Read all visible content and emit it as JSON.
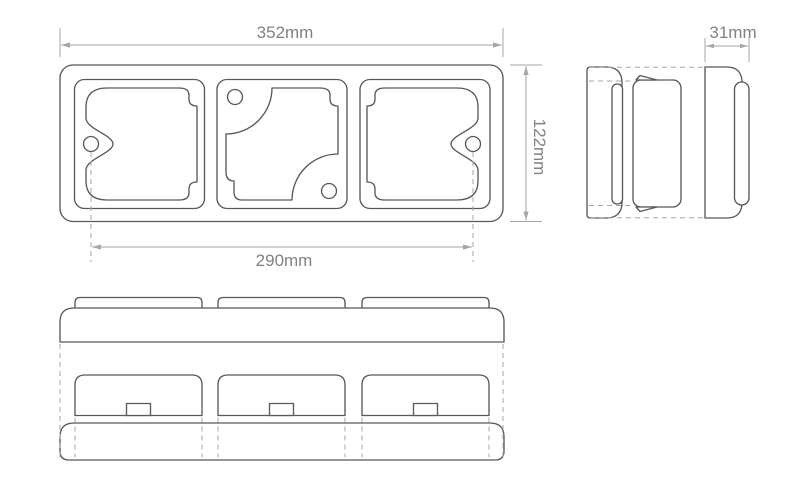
{
  "drawing": {
    "type": "technical-orthographic-drawing",
    "colors": {
      "outline": "#58595b",
      "dim": "#a6a6a6",
      "text": "#7f8183",
      "background": "#ffffff"
    },
    "dimensions": {
      "overall_width": "352mm",
      "overall_height": "122mm",
      "mounting_centres": "290mm",
      "depth": "31mm"
    }
  }
}
